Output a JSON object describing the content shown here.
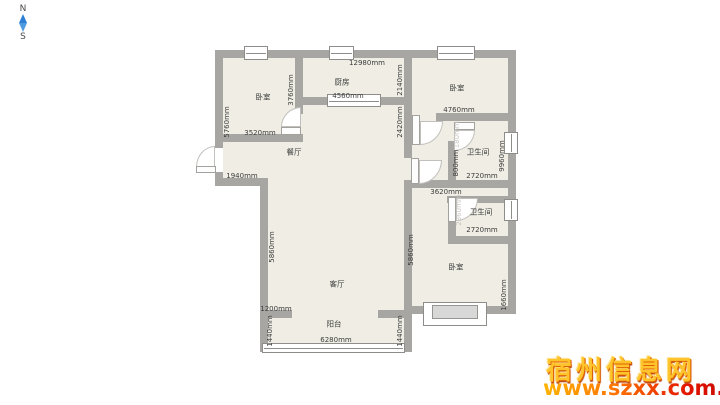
{
  "compass": {
    "north": "N",
    "south": "S"
  },
  "rooms": {
    "bedroom_tl": "卧室",
    "kitchen": "厨房",
    "bedroom_tr": "卧室",
    "dining": "餐厅",
    "living": "客厅",
    "balcony": "阳台",
    "bathroom_upper": "卫生间",
    "bathroom_lower": "卫生间",
    "bedroom_br": "卧室"
  },
  "dimensions": {
    "top_total": "12980mm",
    "bedroom_tl_left": "5760mm",
    "bedroom_tl_bottom": "3520mm",
    "bedroom_tl_right": "3760mm",
    "kitchen_bottom": "4560mm",
    "kitchen_right": "2140mm",
    "hall_right": "2420mm",
    "bedroom_tr_bottom": "4760mm",
    "entry_wall": "1940mm",
    "dining_left": "5860mm",
    "living_right": "5860mm",
    "bathroom_upper_door": "1180mm",
    "bathroom_upper_left": "800mm",
    "bathroom_upper_bottom": "2720mm",
    "right_side": "9960mm",
    "hall_bottom": "3620mm",
    "bathroom_lower_door": "2360mm",
    "bathroom_lower_bottom": "2720mm",
    "bedroom_br_right": "1660mm",
    "living_bottom_wall": "1200mm",
    "balcony_left": "1440mm",
    "balcony_right": "1440mm",
    "balcony_bottom": "6280mm"
  },
  "watermark": {
    "site_name": "宿州信息网",
    "site_url": "www.szxx.com.cn"
  },
  "colors": {
    "wall": "#a8a6a2",
    "floor": "#efede4",
    "compass_blue": "#2d7fd6",
    "watermark_yellow": "#ffc32b",
    "watermark_red": "#e02800"
  }
}
